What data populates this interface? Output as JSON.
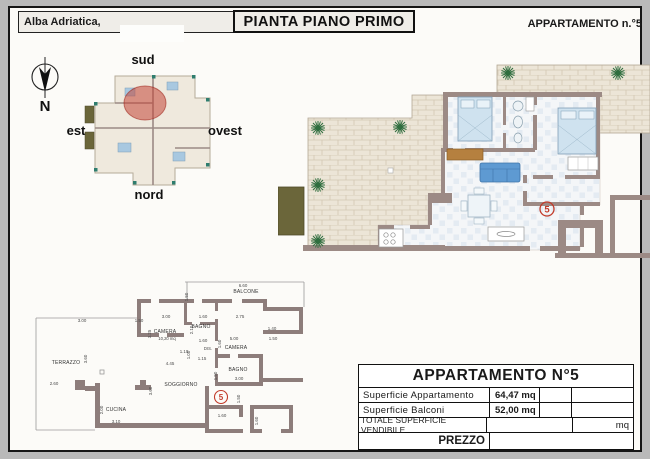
{
  "header": {
    "location_label": "Alba Adriatica,",
    "title": "PIANTA PIANO PRIMO",
    "apartment_ref": "APPARTAMENTO n.°5"
  },
  "compass": {
    "north": "N"
  },
  "site_plan": {
    "label_top": "sud",
    "label_left": "est",
    "label_right": "ovest",
    "label_bottom": "nord"
  },
  "large_plan": {
    "unit_number": "5"
  },
  "small_plan": {
    "unit_number": "5",
    "rooms": {
      "balcone": "BALCONE",
      "camera1": "CAMERA",
      "camera1_area": "10,20 mq",
      "bagno1": "BAGNO",
      "dis": "DIS.",
      "camera2": "CAMERA",
      "bagno2": "BAGNO",
      "soggiorno": "SOGGIORNO",
      "cucina": "CUCINA",
      "terrazzo": "TERRAZZO"
    },
    "dims": [
      "6.60",
      "1.50",
      "3.00",
      "1.60",
      "2.75",
      "1.40",
      "1.50",
      "3.25",
      "2.10",
      "1.60",
      "1.60",
      "5.00",
      "1.00",
      "1.15",
      "1.10",
      "4.45",
      "1.50",
      "3.00",
      "3.00",
      "1.50",
      "3.60",
      "2.60",
      "2.00",
      "3.10",
      "3.60",
      "1.60",
      "1.60",
      "1.50"
    ]
  },
  "summary_table": {
    "title": "APPARTAMENTO N°5",
    "rows": [
      {
        "label": "Superficie  Appartamento",
        "value": "64,47 mq"
      },
      {
        "label": "Superficie  Balconi",
        "value": "52,00 mq"
      }
    ],
    "total_label": "TOTALE  SUPERFICIE  VENDIBILE",
    "total_unit": "mq",
    "price_label": "PREZZO"
  },
  "colors": {
    "accent_red": "#c23b2a",
    "wall": "#9c8a85",
    "terrace_stone": "#ece5d7",
    "plant_green": "#2f6e3f",
    "sofa_blue": "#5e9ad2",
    "olive": "#6b663a"
  }
}
